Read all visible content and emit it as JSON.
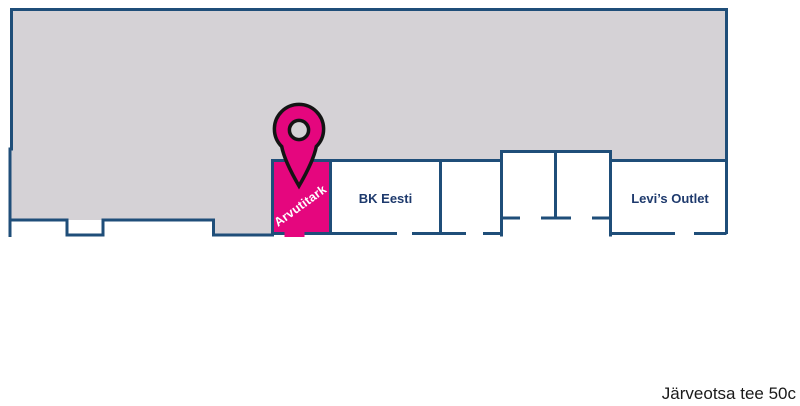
{
  "colors": {
    "floor_fill": "#d5d2d6",
    "wall": "#1f4e79",
    "unit_label": "#1e3a6d",
    "highlight": "#e5067e",
    "pin_outline": "#141414",
    "caption_text": "#1a1a1a",
    "background": "#ffffff"
  },
  "icons": {
    "pin": "map-pin-icon"
  },
  "units": {
    "arvutitark": {
      "label": "Arvutitark",
      "highlighted": true
    },
    "bk_eesti": {
      "label": "BK Eesti"
    },
    "levis_outlet": {
      "label": "Levi’s Outlet"
    }
  },
  "caption": "Järveotsa tee 50c"
}
